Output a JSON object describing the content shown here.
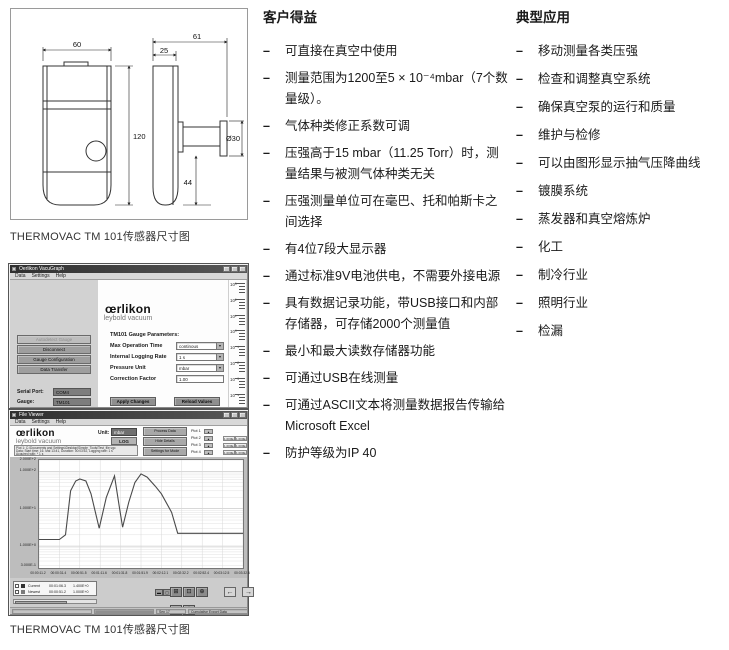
{
  "page": {
    "caption_drawing": "THERMOVAC TM 101传感器尺寸图",
    "caption_software": "THERMOVAC TM 101传感器尺寸图",
    "bullet": "–"
  },
  "icons": {
    "dropdown": "▼",
    "up": "▲",
    "down": "▼"
  },
  "drawing": {
    "width_top": "60",
    "depth_total": "61",
    "depth_front": "25",
    "height": "120",
    "flange_offset": "44",
    "flange_diameter": "Ø30"
  },
  "benefits": {
    "title": "客户得益",
    "items": [
      "可直接在真空中使用",
      "测量范围为1200至5 × 10⁻⁴mbar（7个数量级）。",
      "气体种类修正系数可调",
      "压强高于15 mbar（11.25 Torr）时，测量结果与被测气体种类无关",
      "压强测量单位可在毫巴、托和帕斯卡之间选择",
      "有4位7段大显示器",
      "通过标准9V电池供电，不需要外接电源",
      "具有数据记录功能，带USB接口和内部存储器，可存储2000个测量值",
      "最小和最大读数存储器功能",
      "可通过USB在线测量",
      "可通过ASCII文本将测量数据报告传输给Microsoft Excel",
      "防护等级为IP 40"
    ]
  },
  "applications": {
    "title": "典型应用",
    "items": [
      "移动测量各类压强",
      "检查和调整真空系统",
      "确保真空泵的运行和质量",
      "维护与检修",
      "可以由图形显示抽气压降曲线",
      "镀膜系统",
      "蒸发器和真空熔炼炉",
      "化工",
      "制冷行业",
      "照明行业",
      "检漏"
    ]
  },
  "vacugraph": {
    "window_title": "Oerlikon VacuGraph",
    "menu": [
      "Data",
      "Settings",
      "Help"
    ],
    "logo": {
      "brand": "œrlikon",
      "sub": "leybold vacuum"
    },
    "sidebar_buttons": [
      {
        "label": "Autodetect Gauge",
        "enabled": false
      },
      {
        "label": "Disconnect",
        "enabled": true
      },
      {
        "label": "Gauge Configuration",
        "enabled": true
      },
      {
        "label": "Data Transfer",
        "enabled": true
      }
    ],
    "params_title": "TM101 Gauge Parameters:",
    "fields": [
      {
        "label": "Max Operation Time",
        "value": "continous",
        "control": "select"
      },
      {
        "label": "Internal Logging Rate",
        "value": "1 s",
        "control": "select"
      },
      {
        "label": "Pressure Unit",
        "value": "mbar",
        "control": "select"
      },
      {
        "label": "Correction Factor",
        "value": "1.00",
        "control": "input"
      }
    ],
    "action_buttons": [
      "Apply Changes",
      "Reload Values"
    ],
    "status_fields": [
      {
        "label": "Serial Port:",
        "value": "COM4"
      },
      {
        "label": "Gauge:",
        "value": "TM101"
      }
    ],
    "bargraph_scale": [
      "10³",
      "10²",
      "10¹",
      "10⁰",
      "10⁻¹",
      "10⁻²",
      "10⁻³",
      "10⁻⁴"
    ]
  },
  "viewer": {
    "window_title": "File Viewer",
    "menu": [
      "Data",
      "Settings",
      "Help"
    ],
    "logo": {
      "brand": "œrlikon",
      "sub": "leybold vacuum"
    },
    "unit_label": "Unit:",
    "unit_value": "mbar",
    "log_button": "LOG",
    "file_info_lines": [
      "Plot 1: C:\\Documents and Settings\\Desktop\\Simple_Tools\\Test_file.vgc",
      "Data: Start time: 16. Mai 13:41, Duration: 00:03:52, Logging rate: 1 s",
      "Acquired with: * 1 s"
    ],
    "header_buttons": [
      "Process Data",
      "Hide Details",
      "Settings for Mode"
    ],
    "plots": [
      {
        "label": "Plot 1",
        "values": [
          "1.000E+3",
          "1.000E-3"
        ]
      },
      {
        "label": "Plot 2",
        "values": [
          "1.000E+3",
          "1.000E-3"
        ]
      },
      {
        "label": "Plot 3",
        "values": [
          "1.000E+3",
          "1.000E-3"
        ]
      },
      {
        "label": "Plot 4",
        "values": [
          "1.000E+3",
          "1.000E-3"
        ]
      }
    ],
    "legend": [
      {
        "name": "Current",
        "time": "00:01:06.3",
        "value": "1.400E+0"
      },
      {
        "name": "Newest",
        "time": "00:00:51.2",
        "value": "1.000E+0"
      }
    ],
    "zoom_tools": [
      "⊞",
      "⊡",
      "⊕",
      "+",
      "✛"
    ],
    "mini_buttons": [
      "▬",
      "▢"
    ],
    "pan_left": "←",
    "pan_right": "→",
    "status_center": "Sep 17",
    "status_right": "Cumulative Export Data"
  },
  "chart_data": {
    "type": "line",
    "title": "",
    "xlabel": "",
    "ylabel": "",
    "yscale": "log",
    "ylim": [
      0.26,
      200
    ],
    "grid": true,
    "legend_position": "bottom-left",
    "yticks": [
      {
        "v": 200,
        "label": "2.000E+2"
      },
      {
        "v": 100,
        "label": "1.000E+2"
      },
      {
        "v": 10,
        "label": "1.000E+1"
      },
      {
        "v": 1,
        "label": "1.000E+0"
      },
      {
        "v": 0.3,
        "label": "3.000E-1"
      }
    ],
    "xticks": [
      "00:00:11.2",
      "00:00:31.4",
      "00:00:51.5",
      "00:01:11.6",
      "00:01:31.8",
      "00:01:51.9",
      "00:02:12.1",
      "00:02:32.2",
      "00:02:52.4",
      "00:03:12.5",
      "00:03:32.6"
    ],
    "series": [
      {
        "name": "Plot 1",
        "points": [
          [
            0,
            1.5
          ],
          [
            0.1,
            1.5
          ],
          [
            0.13,
            2
          ],
          [
            0.155,
            30
          ],
          [
            0.18,
            55
          ],
          [
            0.2,
            62
          ],
          [
            0.23,
            55
          ],
          [
            0.255,
            25
          ],
          [
            0.295,
            3
          ],
          [
            0.33,
            20
          ],
          [
            0.37,
            75
          ],
          [
            0.395,
            10
          ],
          [
            0.41,
            3.2
          ],
          [
            0.44,
            15
          ],
          [
            0.47,
            50
          ],
          [
            0.5,
            85
          ],
          [
            0.53,
            70
          ],
          [
            0.57,
            40
          ],
          [
            0.6,
            25
          ],
          [
            0.65,
            8
          ],
          [
            0.68,
            2.2
          ],
          [
            1.0,
            2.2
          ]
        ]
      }
    ]
  }
}
